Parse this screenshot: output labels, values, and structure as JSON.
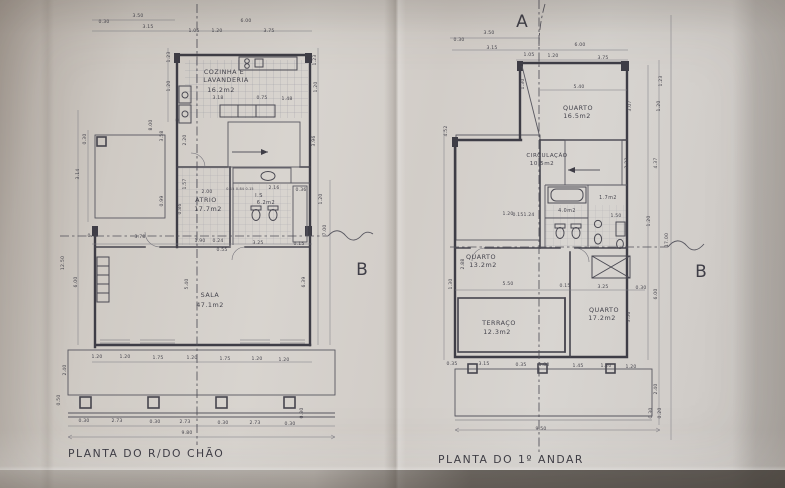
{
  "photo": {
    "paper_color": "#d4d0cb",
    "line_color": "#4b4a52",
    "shadow_color": "#8e867e"
  },
  "section_markers": {
    "a": "A",
    "b_left": "B",
    "b_right": "B"
  },
  "ground_floor": {
    "title": "PLANTA DO R/DO CHÃO",
    "rooms": [
      {
        "name": "COZINHA E LAVANDERIA",
        "area": "16.2m2"
      },
      {
        "name": "ATRIO",
        "area": "17.7m2"
      },
      {
        "name": "I.S",
        "area": "6.2m2"
      },
      {
        "name": "SALA",
        "area": "47.1m2"
      }
    ],
    "overall_dims": {
      "width": "9.80",
      "height": "17.00"
    },
    "labels": [
      {
        "t": "3.50",
        "x": 138,
        "y": 17
      },
      {
        "t": "0.30",
        "x": 104,
        "y": 23
      },
      {
        "t": "3.15",
        "x": 148,
        "y": 28
      },
      {
        "t": "6.00",
        "x": 246,
        "y": 22
      },
      {
        "t": "1.05",
        "x": 194,
        "y": 32
      },
      {
        "t": "1.20",
        "x": 217,
        "y": 32
      },
      {
        "t": "3.75",
        "x": 269,
        "y": 32
      },
      {
        "t": "1.23",
        "x": 170,
        "y": 57,
        "r": -90
      },
      {
        "t": "1.20",
        "x": 170,
        "y": 86,
        "r": -90
      },
      {
        "t": "1.23",
        "x": 316,
        "y": 60,
        "r": -90
      },
      {
        "t": "1.20",
        "x": 317,
        "y": 87,
        "r": -90
      },
      {
        "t": "8.00",
        "x": 152,
        "y": 125,
        "r": -90
      },
      {
        "t": "3.58",
        "x": 163,
        "y": 136,
        "r": -90
      },
      {
        "t": "0.30",
        "x": 86,
        "y": 139,
        "r": -90
      },
      {
        "t": "3.14",
        "x": 79,
        "y": 174,
        "r": -90
      },
      {
        "t": "0.99",
        "x": 163,
        "y": 201,
        "r": -90
      },
      {
        "t": "2.20",
        "x": 186,
        "y": 140,
        "r": -90
      },
      {
        "t": "1.57",
        "x": 186,
        "y": 184,
        "r": -90
      },
      {
        "t": "0.86",
        "x": 181,
        "y": 209,
        "r": -90
      },
      {
        "t": "12.50",
        "x": 64,
        "y": 263,
        "r": -90
      },
      {
        "t": "6.00",
        "x": 77,
        "y": 282,
        "r": -90
      },
      {
        "t": "3.96",
        "x": 315,
        "y": 141,
        "r": -90
      },
      {
        "t": "1.20",
        "x": 322,
        "y": 199,
        "r": -90
      },
      {
        "t": "7.00",
        "x": 326,
        "y": 230,
        "r": -90
      },
      {
        "t": "0.30",
        "x": 93,
        "y": 237
      },
      {
        "t": "3.78",
        "x": 140,
        "y": 238
      },
      {
        "t": "1.90",
        "x": 200,
        "y": 242
      },
      {
        "t": "0.24",
        "x": 218,
        "y": 242
      },
      {
        "t": "0.55",
        "x": 222,
        "y": 251
      },
      {
        "t": "3.25",
        "x": 258,
        "y": 244
      },
      {
        "t": "0.15",
        "x": 299,
        "y": 245
      },
      {
        "t": "5.40",
        "x": 188,
        "y": 284,
        "r": -90
      },
      {
        "t": "6.39",
        "x": 305,
        "y": 282,
        "r": -90
      },
      {
        "t": "3.18",
        "x": 218,
        "y": 99
      },
      {
        "t": "0.75",
        "x": 262,
        "y": 99
      },
      {
        "t": "1.48",
        "x": 287,
        "y": 100
      },
      {
        "t": "2.00",
        "x": 207,
        "y": 193
      },
      {
        "t": "0.15 0.84 0.15",
        "x": 240,
        "y": 190,
        "s": 3.4
      },
      {
        "t": "2.16",
        "x": 274,
        "y": 189
      },
      {
        "t": "0.36",
        "x": 301,
        "y": 191
      },
      {
        "t": "1.20",
        "x": 97,
        "y": 358
      },
      {
        "t": "1.20",
        "x": 125,
        "y": 358
      },
      {
        "t": "1.75",
        "x": 158,
        "y": 359
      },
      {
        "t": "1.20",
        "x": 192,
        "y": 359
      },
      {
        "t": "1.75",
        "x": 225,
        "y": 360
      },
      {
        "t": "1.20",
        "x": 257,
        "y": 360
      },
      {
        "t": "1.20",
        "x": 284,
        "y": 361
      },
      {
        "t": "2.40",
        "x": 66,
        "y": 370,
        "r": -90
      },
      {
        "t": "0.50",
        "x": 60,
        "y": 400,
        "r": -90
      },
      {
        "t": "0.30",
        "x": 84,
        "y": 422
      },
      {
        "t": "2.73",
        "x": 117,
        "y": 422
      },
      {
        "t": "0.30",
        "x": 155,
        "y": 423
      },
      {
        "t": "2.73",
        "x": 185,
        "y": 423
      },
      {
        "t": "0.30",
        "x": 223,
        "y": 424
      },
      {
        "t": "2.73",
        "x": 255,
        "y": 424
      },
      {
        "t": "0.30",
        "x": 290,
        "y": 425
      },
      {
        "t": "9.80",
        "x": 187,
        "y": 434
      },
      {
        "t": "0.30",
        "x": 303,
        "y": 413,
        "r": -90
      },
      {
        "t": "COZINHA E",
        "x": 224,
        "y": 74,
        "k": "room"
      },
      {
        "t": "LAVANDERIA",
        "x": 226,
        "y": 82,
        "k": "room"
      },
      {
        "t": "16.2m2",
        "x": 221,
        "y": 92,
        "k": "room"
      },
      {
        "t": "ATRIO",
        "x": 206,
        "y": 202,
        "k": "room"
      },
      {
        "t": "17.7m2",
        "x": 208,
        "y": 211,
        "k": "room"
      },
      {
        "t": "I.S",
        "x": 259,
        "y": 197,
        "k": "room",
        "s": 5
      },
      {
        "t": "6.2m2",
        "x": 266,
        "y": 204,
        "k": "room",
        "s": 5
      },
      {
        "t": "SALA",
        "x": 210,
        "y": 297,
        "k": "room"
      },
      {
        "t": "47.1m2",
        "x": 210,
        "y": 307,
        "k": "room"
      }
    ]
  },
  "first_floor": {
    "title": "PLANTA DO 1º ANDAR",
    "rooms": [
      {
        "name": "QUARTO",
        "area": "16.5m2"
      },
      {
        "name": "CIRCULAÇÃO",
        "area": "10.5m2"
      },
      {
        "name": "I.S",
        "area": "4.0m2"
      },
      {
        "name": "I.S",
        "area": "1.7m2"
      },
      {
        "name": "QUARTO",
        "area": "13.2m2"
      },
      {
        "name": "TERRAÇO",
        "area": "12.3m2"
      },
      {
        "name": "QUARTO",
        "area": "17.2m2"
      }
    ],
    "overall_dims": {
      "width": "9.50",
      "height": "17.00"
    },
    "labels": [
      {
        "t": "3.50",
        "x": 489,
        "y": 34
      },
      {
        "t": "0.30",
        "x": 459,
        "y": 41
      },
      {
        "t": "3.15",
        "x": 492,
        "y": 49
      },
      {
        "t": "6.00",
        "x": 580,
        "y": 46
      },
      {
        "t": "1.05",
        "x": 529,
        "y": 56
      },
      {
        "t": "1.20",
        "x": 553,
        "y": 57
      },
      {
        "t": "3.75",
        "x": 603,
        "y": 59
      },
      {
        "t": "5.40",
        "x": 579,
        "y": 88
      },
      {
        "t": "1.23",
        "x": 662,
        "y": 81,
        "r": -90
      },
      {
        "t": "1.20",
        "x": 660,
        "y": 106,
        "r": -90
      },
      {
        "t": "3.07",
        "x": 631,
        "y": 106,
        "r": -90
      },
      {
        "t": "1.30",
        "x": 524,
        "y": 84,
        "r": -90
      },
      {
        "t": "4.52",
        "x": 447,
        "y": 131,
        "r": -90
      },
      {
        "t": "QUARTO",
        "x": 578,
        "y": 110,
        "k": "room"
      },
      {
        "t": "16.5m2",
        "x": 577,
        "y": 118,
        "k": "room"
      },
      {
        "t": "CIRCULAÇÃO",
        "x": 547,
        "y": 157,
        "k": "room",
        "s": 5.6
      },
      {
        "t": "10.5m2",
        "x": 542,
        "y": 165,
        "k": "room",
        "s": 5.6
      },
      {
        "t": "2.23",
        "x": 628,
        "y": 163,
        "r": -90
      },
      {
        "t": "4.37",
        "x": 657,
        "y": 163,
        "r": -90
      },
      {
        "t": "4.0m2",
        "x": 567,
        "y": 212,
        "k": "room",
        "s": 4.8
      },
      {
        "t": "1.7m2",
        "x": 608,
        "y": 199,
        "k": "room",
        "s": 4.8
      },
      {
        "t": "1.20",
        "x": 508,
        "y": 215
      },
      {
        "t": "0.15",
        "x": 518,
        "y": 216
      },
      {
        "t": "1.24",
        "x": 529,
        "y": 216
      },
      {
        "t": "1.50",
        "x": 616,
        "y": 217
      },
      {
        "t": "1.20",
        "x": 650,
        "y": 221,
        "r": -90
      },
      {
        "t": "QUARTO",
        "x": 481,
        "y": 259,
        "k": "room"
      },
      {
        "t": "13.2m2",
        "x": 483,
        "y": 267,
        "k": "room"
      },
      {
        "t": "2.88",
        "x": 464,
        "y": 264,
        "r": -90
      },
      {
        "t": "1.30",
        "x": 452,
        "y": 284,
        "r": -90
      },
      {
        "t": "5.50",
        "x": 508,
        "y": 285
      },
      {
        "t": "0.15",
        "x": 565,
        "y": 287
      },
      {
        "t": "3.25",
        "x": 603,
        "y": 288
      },
      {
        "t": "0.30",
        "x": 641,
        "y": 289
      },
      {
        "t": "TERRAÇO",
        "x": 499,
        "y": 325,
        "k": "room"
      },
      {
        "t": "12.3m2",
        "x": 497,
        "y": 334,
        "k": "room"
      },
      {
        "t": "QUARTO",
        "x": 604,
        "y": 312,
        "k": "room"
      },
      {
        "t": "17.2m2",
        "x": 602,
        "y": 320,
        "k": "room"
      },
      {
        "t": "3.56",
        "x": 630,
        "y": 317,
        "r": -90
      },
      {
        "t": "6.00",
        "x": 657,
        "y": 294,
        "r": -90
      },
      {
        "t": "17.00",
        "x": 668,
        "y": 240,
        "r": -90
      },
      {
        "t": "0.35",
        "x": 452,
        "y": 365
      },
      {
        "t": "3.15",
        "x": 484,
        "y": 365
      },
      {
        "t": "0.35",
        "x": 521,
        "y": 366
      },
      {
        "t": "1.80",
        "x": 544,
        "y": 366
      },
      {
        "t": "1.45",
        "x": 578,
        "y": 367
      },
      {
        "t": "1.20",
        "x": 606,
        "y": 367
      },
      {
        "t": "1.20",
        "x": 631,
        "y": 368
      },
      {
        "t": "2.40",
        "x": 657,
        "y": 389,
        "r": -90
      },
      {
        "t": "0.30",
        "x": 652,
        "y": 413,
        "r": -90
      },
      {
        "t": "0.20",
        "x": 661,
        "y": 413,
        "r": -90
      },
      {
        "t": "9.50",
        "x": 541,
        "y": 430
      }
    ]
  }
}
